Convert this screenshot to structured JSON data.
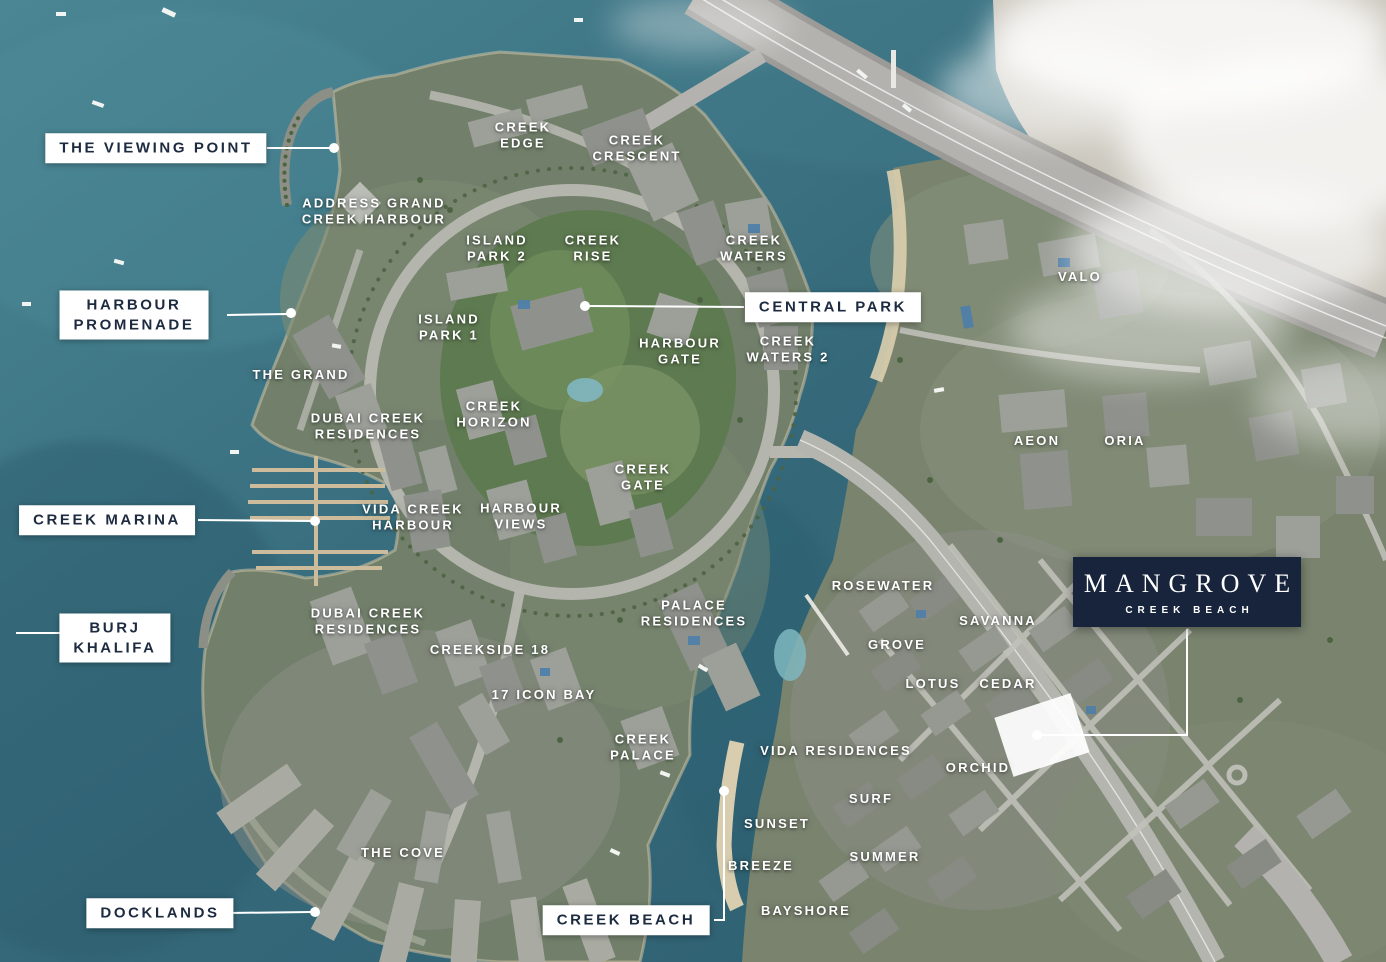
{
  "colors": {
    "feature_navy": "#17243c",
    "callout_text_navy": "#1d2b40",
    "label_white": "#ffffff",
    "water_teal": "#3a7181"
  },
  "labels": {
    "boxed": [
      {
        "id": "the-viewing-point",
        "lines": [
          "THE VIEWING POINT"
        ]
      },
      {
        "id": "harbour-promenade",
        "lines": [
          "HARBOUR",
          "PROMENADE"
        ]
      },
      {
        "id": "central-park",
        "lines": [
          "CENTRAL PARK"
        ]
      },
      {
        "id": "creek-marina",
        "lines": [
          "CREEK MARINA"
        ]
      },
      {
        "id": "burj-khalifa",
        "lines": [
          "BURJ",
          "KHALIFA"
        ]
      },
      {
        "id": "docklands",
        "lines": [
          "DOCKLANDS"
        ]
      },
      {
        "id": "creek-beach",
        "lines": [
          "CREEK BEACH"
        ]
      }
    ],
    "featured": {
      "title": "MANGROVE",
      "subtitle": "CREEK BEACH"
    },
    "places": [
      {
        "id": "address-grand-creek-harbour",
        "lines": [
          "ADDRESS GRAND",
          "CREEK HARBOUR"
        ]
      },
      {
        "id": "creek-edge",
        "lines": [
          "CREEK",
          "EDGE"
        ]
      },
      {
        "id": "creek-crescent",
        "lines": [
          "CREEK",
          "CRESCENT"
        ]
      },
      {
        "id": "island-park-2",
        "lines": [
          "ISLAND",
          "PARK 2"
        ]
      },
      {
        "id": "creek-rise",
        "lines": [
          "CREEK",
          "RISE"
        ]
      },
      {
        "id": "creek-waters",
        "lines": [
          "CREEK",
          "WATERS"
        ]
      },
      {
        "id": "island-park-1",
        "lines": [
          "ISLAND",
          "PARK 1"
        ]
      },
      {
        "id": "the-grand",
        "lines": [
          "THE GRAND"
        ]
      },
      {
        "id": "dubai-creek-residences-north",
        "lines": [
          "DUBAI CREEK",
          "RESIDENCES"
        ]
      },
      {
        "id": "creek-horizon",
        "lines": [
          "CREEK",
          "HORIZON"
        ]
      },
      {
        "id": "harbour-gate",
        "lines": [
          "HARBOUR",
          "GATE"
        ]
      },
      {
        "id": "creek-waters-2",
        "lines": [
          "CREEK",
          "WATERS 2"
        ]
      },
      {
        "id": "valo",
        "lines": [
          "VALO"
        ]
      },
      {
        "id": "aeon",
        "lines": [
          "AEON"
        ]
      },
      {
        "id": "oria",
        "lines": [
          "ORIA"
        ]
      },
      {
        "id": "creek-gate",
        "lines": [
          "CREEK",
          "GATE"
        ]
      },
      {
        "id": "vida-creek-harbour",
        "lines": [
          "VIDA CREEK",
          "HARBOUR"
        ]
      },
      {
        "id": "harbour-views",
        "lines": [
          "HARBOUR",
          "VIEWS"
        ]
      },
      {
        "id": "dubai-creek-residences-south",
        "lines": [
          "DUBAI CREEK",
          "RESIDENCES"
        ]
      },
      {
        "id": "creekside-18",
        "lines": [
          "CREEKSIDE 18"
        ]
      },
      {
        "id": "palace-residences",
        "lines": [
          "PALACE",
          "RESIDENCES"
        ]
      },
      {
        "id": "17-icon-bay",
        "lines": [
          "17 ICON BAY"
        ]
      },
      {
        "id": "creek-palace",
        "lines": [
          "CREEK",
          "PALACE"
        ]
      },
      {
        "id": "rosewater",
        "lines": [
          "ROSEWATER"
        ]
      },
      {
        "id": "savanna",
        "lines": [
          "SAVANNA"
        ]
      },
      {
        "id": "grove",
        "lines": [
          "GROVE"
        ]
      },
      {
        "id": "lotus",
        "lines": [
          "LOTUS"
        ]
      },
      {
        "id": "cedar",
        "lines": [
          "CEDAR"
        ]
      },
      {
        "id": "orchid",
        "lines": [
          "ORCHID"
        ]
      },
      {
        "id": "vida-residences",
        "lines": [
          "VIDA RESIDENCES"
        ]
      },
      {
        "id": "surf",
        "lines": [
          "SURF"
        ]
      },
      {
        "id": "sunset",
        "lines": [
          "SUNSET"
        ]
      },
      {
        "id": "summer",
        "lines": [
          "SUMMER"
        ]
      },
      {
        "id": "breeze",
        "lines": [
          "BREEZE"
        ]
      },
      {
        "id": "bayshore",
        "lines": [
          "BAYSHORE"
        ]
      },
      {
        "id": "the-cove",
        "lines": [
          "THE COVE"
        ]
      }
    ]
  }
}
